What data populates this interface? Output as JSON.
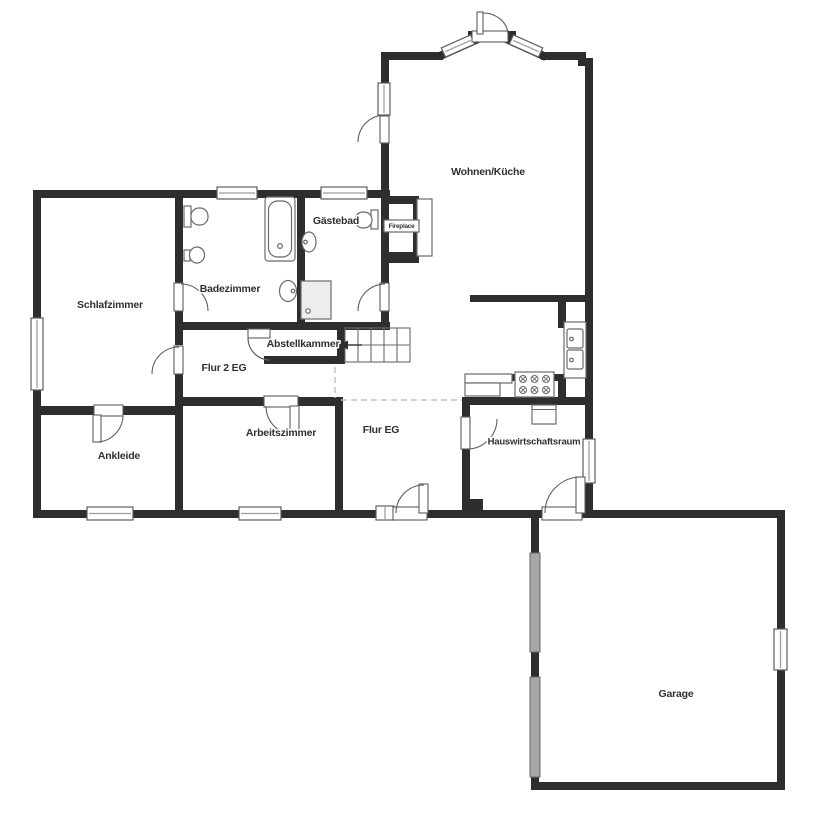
{
  "colors": {
    "wall": "#2e2e2e",
    "frame": "#5e5e5e",
    "winline": "#9e9e9e",
    "door": "#5e5e5e",
    "fixture": "#6a6a6a",
    "garagedoor": "#a7a7a7",
    "shower": "#ededed",
    "dashed": "#c2c2c2",
    "label": "#303030",
    "paper": "#ffffff"
  },
  "plan": {
    "rooms": [
      {
        "id": "wohnen-kueche",
        "label": "Wohnen/Küche"
      },
      {
        "id": "gaestebad",
        "label": "Gästebad"
      },
      {
        "id": "fireplace",
        "label": "Fireplace"
      },
      {
        "id": "badezimmer",
        "label": "Badezimmer"
      },
      {
        "id": "schlafzimmer",
        "label": "Schlafzimmer"
      },
      {
        "id": "abstellkammer",
        "label": "Abstellkammer"
      },
      {
        "id": "flur-2-eg",
        "label": "Flur 2 EG"
      },
      {
        "id": "ankleide",
        "label": "Ankleide"
      },
      {
        "id": "arbeitszimmer",
        "label": "Arbeitszimmer"
      },
      {
        "id": "flur-eg",
        "label": "Flur EG"
      },
      {
        "id": "hauswirtschaftsraum",
        "label": "Hauswirtschaftsraum"
      },
      {
        "id": "garage",
        "label": "Garage"
      }
    ]
  }
}
